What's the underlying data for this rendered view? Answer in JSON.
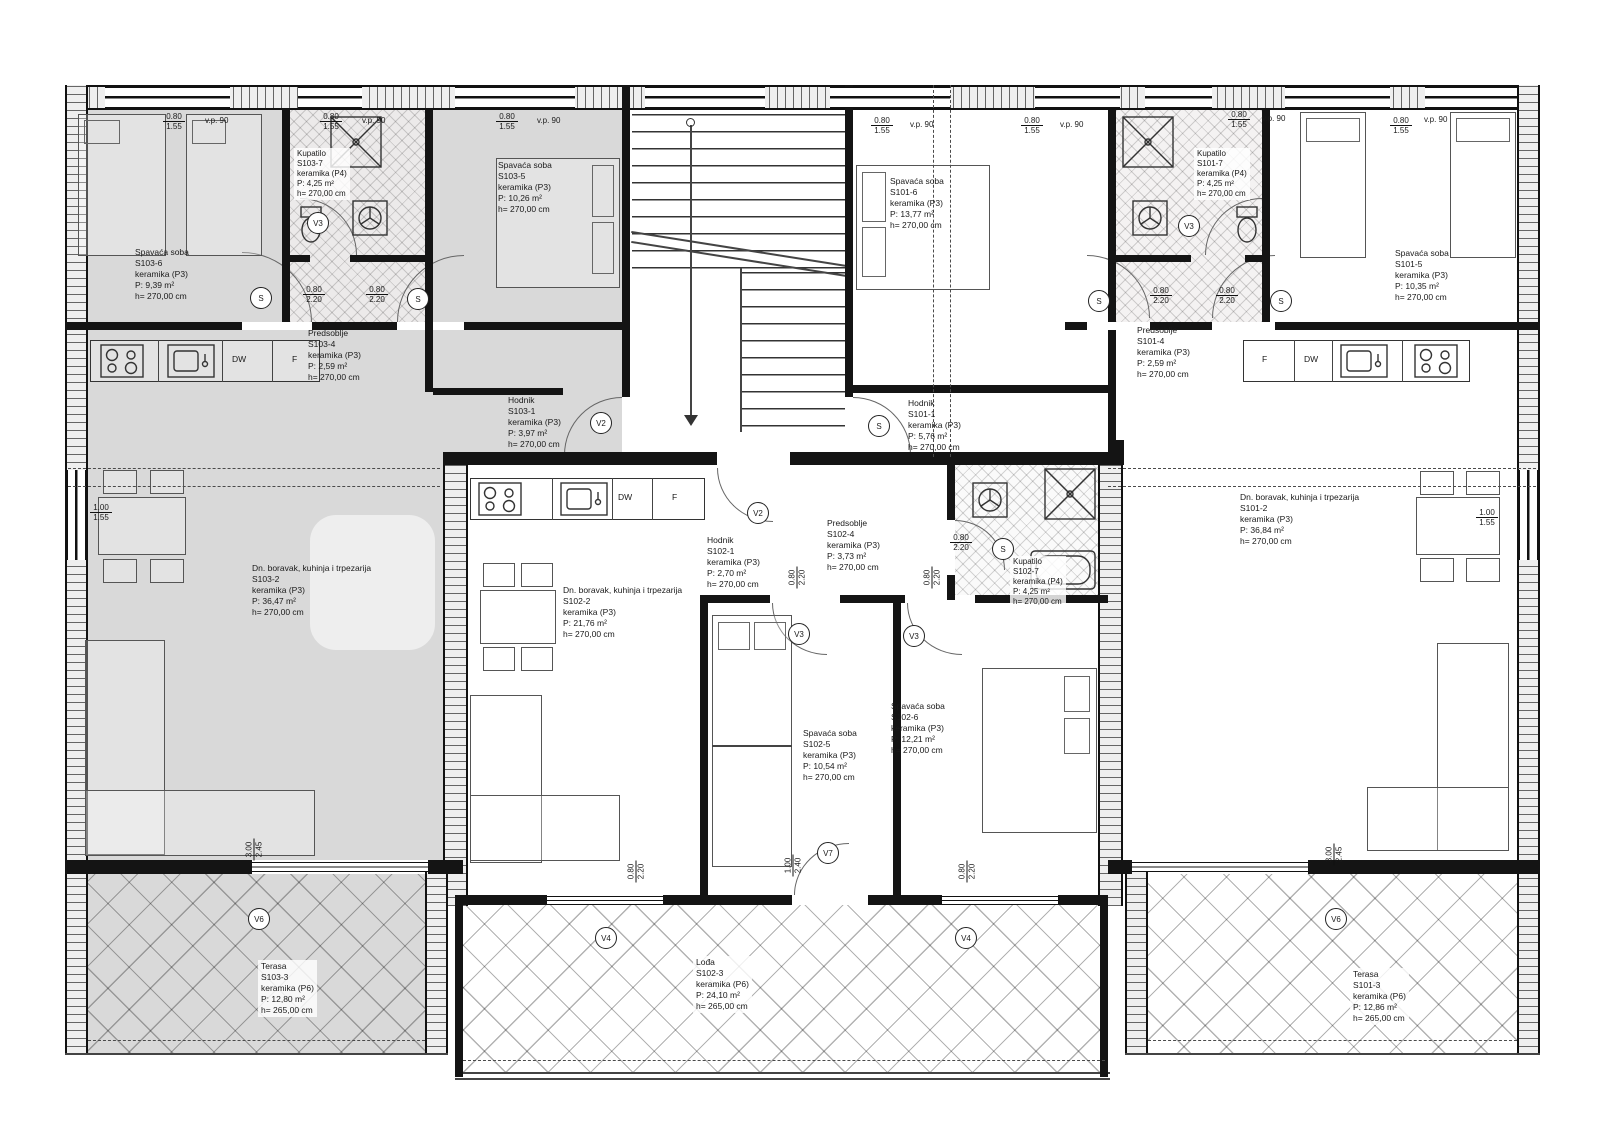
{
  "title": "Floor plan – apartments S101, S102, S103",
  "rooms": {
    "s103_6": {
      "name": "Spavaća soba",
      "id": "S103-6",
      "floor": "keramika (P3)",
      "area": "P: 9,39 m²",
      "height": "h= 270,00 cm"
    },
    "s103_7": {
      "name": "Kupatilo",
      "id": "S103-7",
      "floor": "keramika (P4)",
      "area": "P: 4,25 m²",
      "height": "h= 270,00 cm"
    },
    "s103_5": {
      "name": "Spavaća soba",
      "id": "S103-5",
      "floor": "keramika (P3)",
      "area": "P: 10,26 m²",
      "height": "h= 270,00 cm"
    },
    "s103_4": {
      "name": "Predsoblje",
      "id": "S103-4",
      "floor": "keramika (P3)",
      "area": "P: 2,59 m²",
      "height": "h= 270,00 cm"
    },
    "s103_1": {
      "name": "Hodnik",
      "id": "S103-1",
      "floor": "keramika (P3)",
      "area": "P: 3,97 m²",
      "height": "h= 270,00 cm"
    },
    "s103_2": {
      "name": "Dn. boravak, kuhinja i trpezarija",
      "id": "S103-2",
      "floor": "keramika (P3)",
      "area": "P: 36,47 m²",
      "height": "h= 270,00 cm"
    },
    "s103_3": {
      "name": "Terasa",
      "id": "S103-3",
      "floor": "keramika (P6)",
      "area": "P: 12,80 m²",
      "height": "h= 265,00 cm"
    },
    "s102_1": {
      "name": "Hodnik",
      "id": "S102-1",
      "floor": "keramika (P3)",
      "area": "P: 2,70 m²",
      "height": "h= 270,00 cm"
    },
    "s102_2": {
      "name": "Dn. boravak, kuhinja i trpezarija",
      "id": "S102-2",
      "floor": "keramika (P3)",
      "area": "P: 21,76 m²",
      "height": "h= 270,00 cm"
    },
    "s102_3": {
      "name": "Lođa",
      "id": "S102-3",
      "floor": "keramika (P6)",
      "area": "P: 24,10 m²",
      "height": "h= 265,00 cm"
    },
    "s102_4": {
      "name": "Predsoblje",
      "id": "S102-4",
      "floor": "keramika (P3)",
      "area": "P: 3,73 m²",
      "height": "h= 270,00 cm"
    },
    "s102_5": {
      "name": "Spavaća soba",
      "id": "S102-5",
      "floor": "keramika (P3)",
      "area": "P: 10,54 m²",
      "height": "h= 270,00 cm"
    },
    "s102_6": {
      "name": "Spavaća soba",
      "id": "S102-6",
      "floor": "keramika (P3)",
      "area": "P: 12,21 m²",
      "height": "h= 270,00 cm"
    },
    "s102_7": {
      "name": "Kupatilo",
      "id": "S102-7",
      "floor": "keramika (P4)",
      "area": "P: 4,25 m²",
      "height": "h= 270,00 cm"
    },
    "s101_1": {
      "name": "Hodnik",
      "id": "S101-1",
      "floor": "keramika (P3)",
      "area": "P: 5,76 m²",
      "height": "h= 270,00 cm"
    },
    "s101_2": {
      "name": "Dn. boravak, kuhinja i trpezarija",
      "id": "S101-2",
      "floor": "keramika (P3)",
      "area": "P: 36,84 m²",
      "height": "h= 270,00 cm"
    },
    "s101_3": {
      "name": "Terasa",
      "id": "S101-3",
      "floor": "keramika (P6)",
      "area": "P: 12,86 m²",
      "height": "h= 265,00 cm"
    },
    "s101_4": {
      "name": "Predsoblje",
      "id": "S101-4",
      "floor": "keramika (P3)",
      "area": "P: 2,59 m²",
      "height": "h= 270,00 cm"
    },
    "s101_5": {
      "name": "Spavaća soba",
      "id": "S101-5",
      "floor": "keramika (P3)",
      "area": "P: 10,35 m²",
      "height": "h= 270,00 cm"
    },
    "s101_6": {
      "name": "Spavaća soba",
      "id": "S101-6",
      "floor": "keramika (P3)",
      "area": "P: 13,77 m²",
      "height": "h= 270,00 cm"
    },
    "s101_7": {
      "name": "Kupatilo",
      "id": "S101-7",
      "floor": "keramika (P4)",
      "area": "P: 4,25 m²",
      "height": "h= 270,00 cm"
    }
  },
  "door_tags": {
    "s": "S",
    "v2": "V2",
    "v3": "V3",
    "v4": "V4",
    "v6": "V6",
    "v7": "V7"
  },
  "fixtures": {
    "dw": "DW",
    "f": "F"
  },
  "window_label": {
    "code": "v.p. 90"
  },
  "dims": {
    "d080": "0.80",
    "d100": "1.00",
    "d155": "1.55",
    "d220": "2.20",
    "d240": "2.40",
    "d245": "2.45",
    "d300": "3.00"
  }
}
